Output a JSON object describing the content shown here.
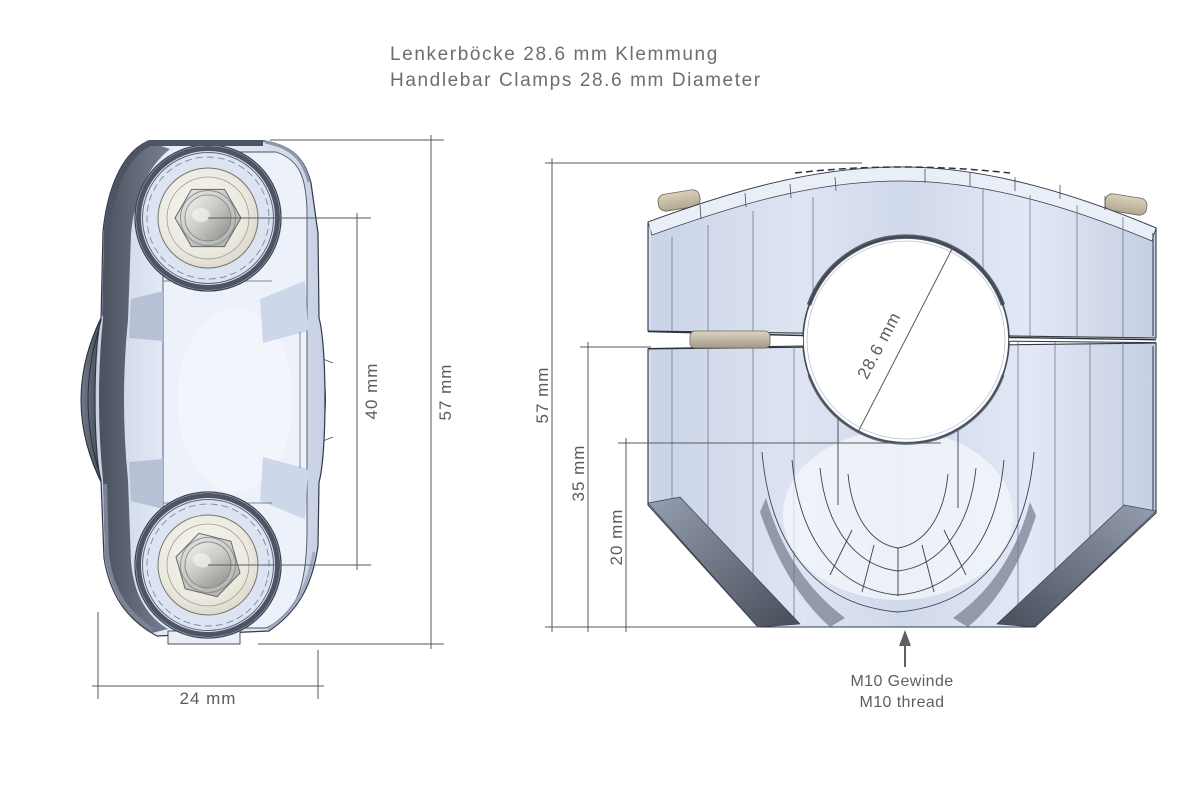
{
  "title": {
    "line1": "Lenkerböcke 28.6 mm Klemmung",
    "line2": "Handlebar Clamps 28.6 mm Diameter"
  },
  "top_view": {
    "dim_bolt_spacing": "40 mm",
    "dim_length": "57 mm",
    "dim_width": "24 mm"
  },
  "front_view": {
    "dim_height": "57 mm",
    "dim_lower_height": "35 mm",
    "dim_bore_bottom_height": "20 mm",
    "dim_bore_diameter": "28.6 mm",
    "thread_note_line1": "M10 Gewinde",
    "thread_note_line2": "M10 thread"
  },
  "colors": {
    "body_light": "#dce4f2",
    "body_dark": "#4d5565",
    "recess_ivory": "#efece0",
    "bolt_metal": "#c9c9c5",
    "washer_beige": "#cfc6b0",
    "dimension_line": "#5a5a5a",
    "dimension_text": "#5c5c5c",
    "title_text": "#6e6e6e"
  }
}
